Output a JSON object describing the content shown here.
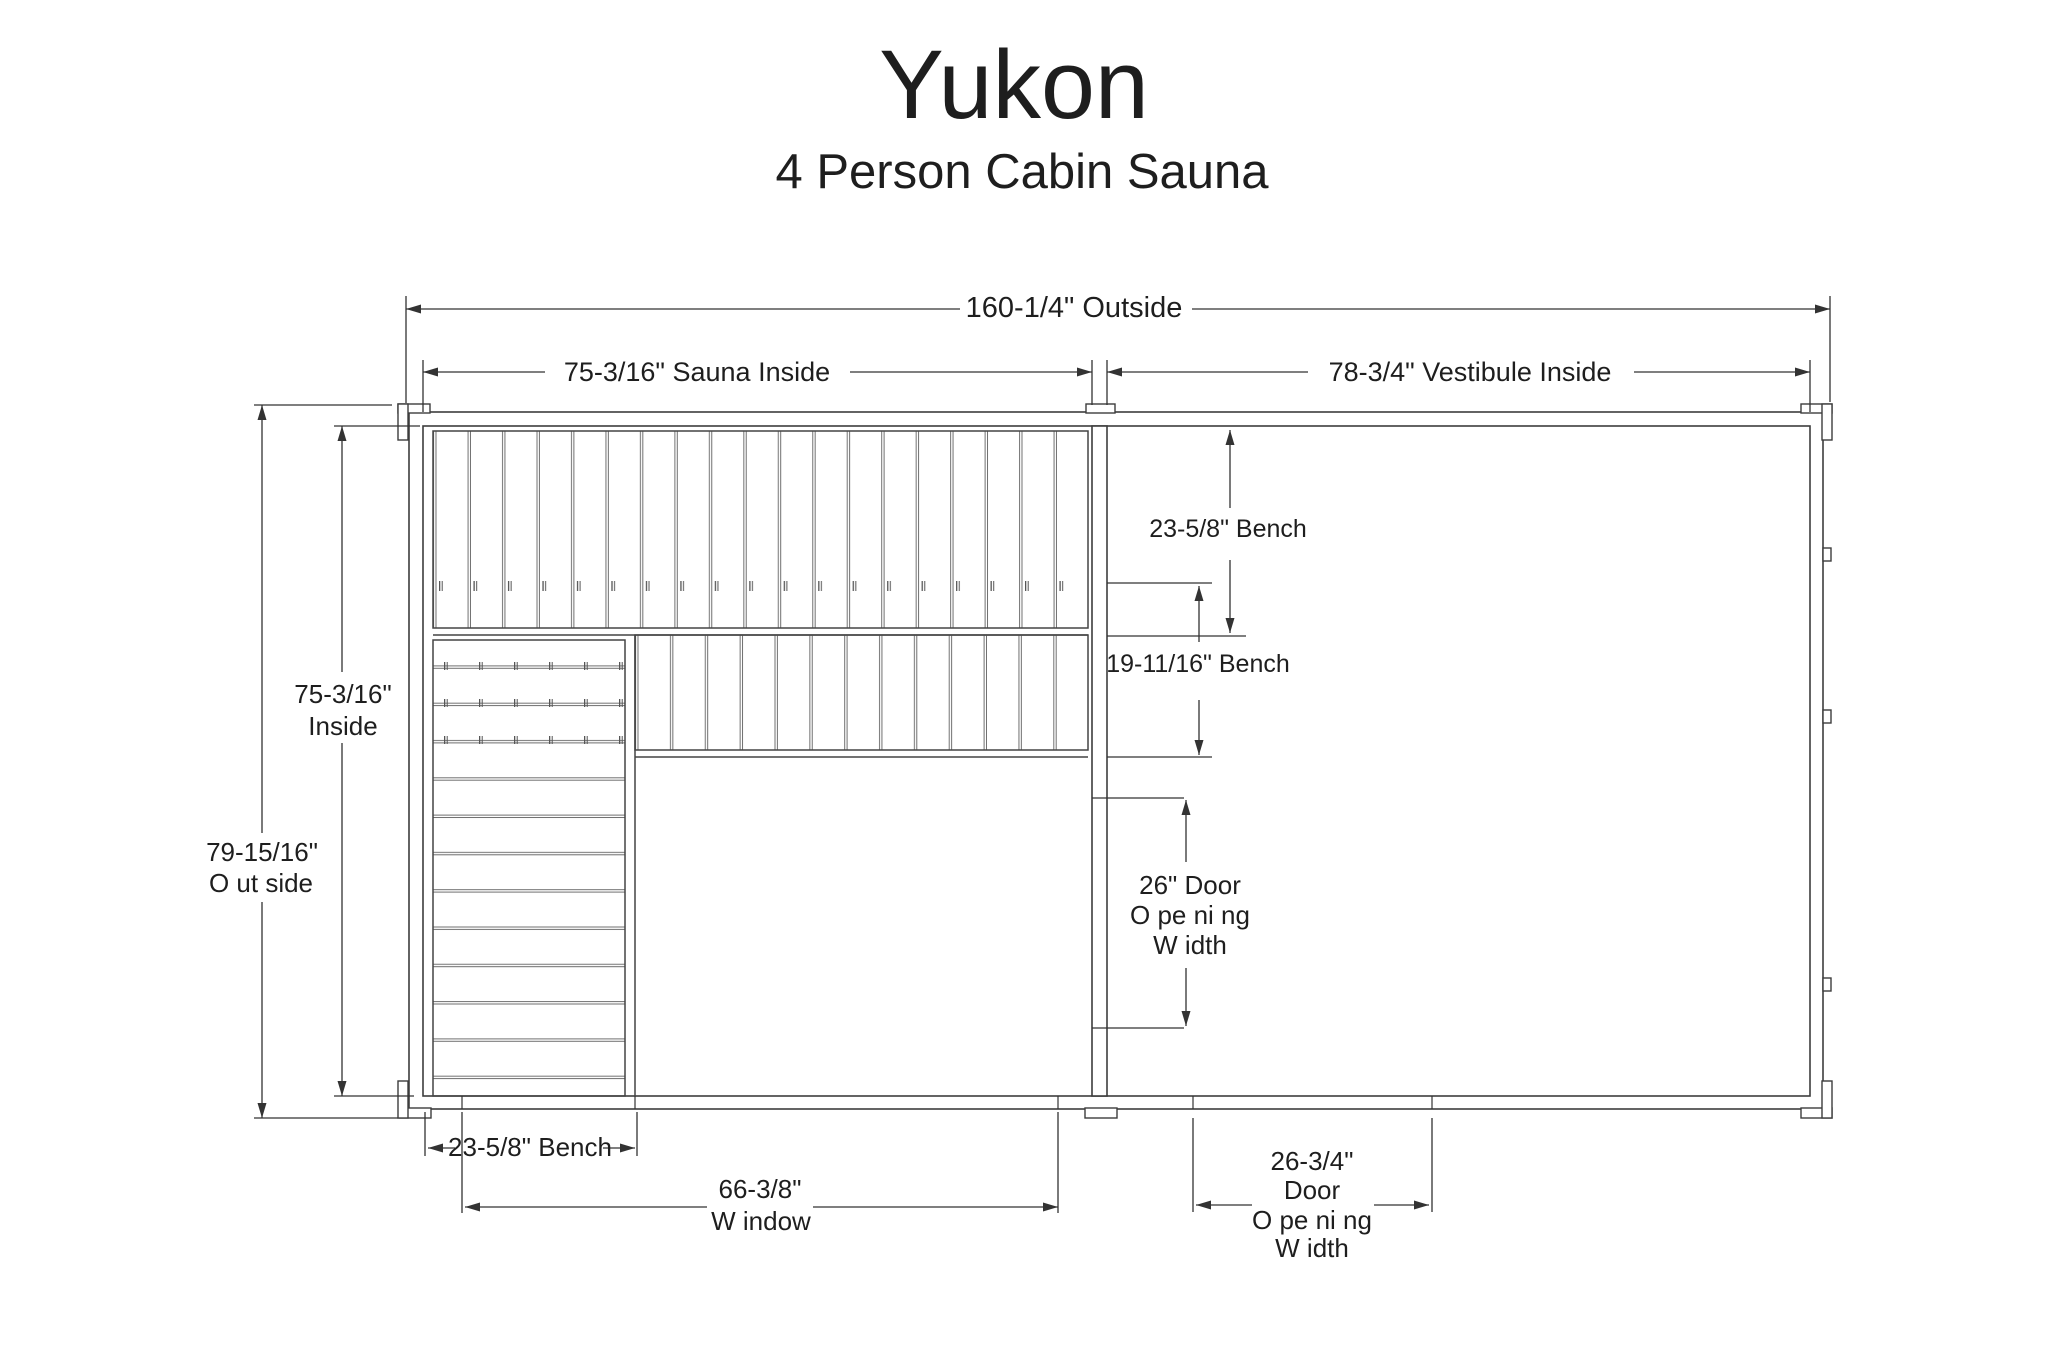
{
  "header": {
    "title": "Yukon",
    "subtitle": "4 Person Cabin Sauna"
  },
  "dims": {
    "outside_width": "160-1/4\" Outside",
    "sauna_inside": "75-3/16\" Sauna Inside",
    "vestibule_inside": "78-3/4\" Vestibule Inside",
    "inside_height": {
      "value": "75-3/16\"",
      "label": "Inside"
    },
    "outside_height": {
      "value": "79-15/16\"",
      "label": "O ut side"
    },
    "bench_upper": "23-5/8\" Bench",
    "bench_lower": "19-11/16\" Bench",
    "door_inner": {
      "l1": "26\" Door",
      "l2": "O pe ni ng",
      "l3": "W idth"
    },
    "bench_bottom": "23-5/8\" Bench",
    "window": {
      "value": "66-3/8\"",
      "label": "W indow"
    },
    "door_outer": {
      "l1": "26-3/4\"",
      "l2": "Door",
      "l3": "O pe ni ng",
      "l4": "W idth"
    }
  },
  "colors": {
    "background": "#ffffff",
    "line": "#3d3d3d",
    "dimension_line": "#333333",
    "text": "#1e1e1e"
  }
}
